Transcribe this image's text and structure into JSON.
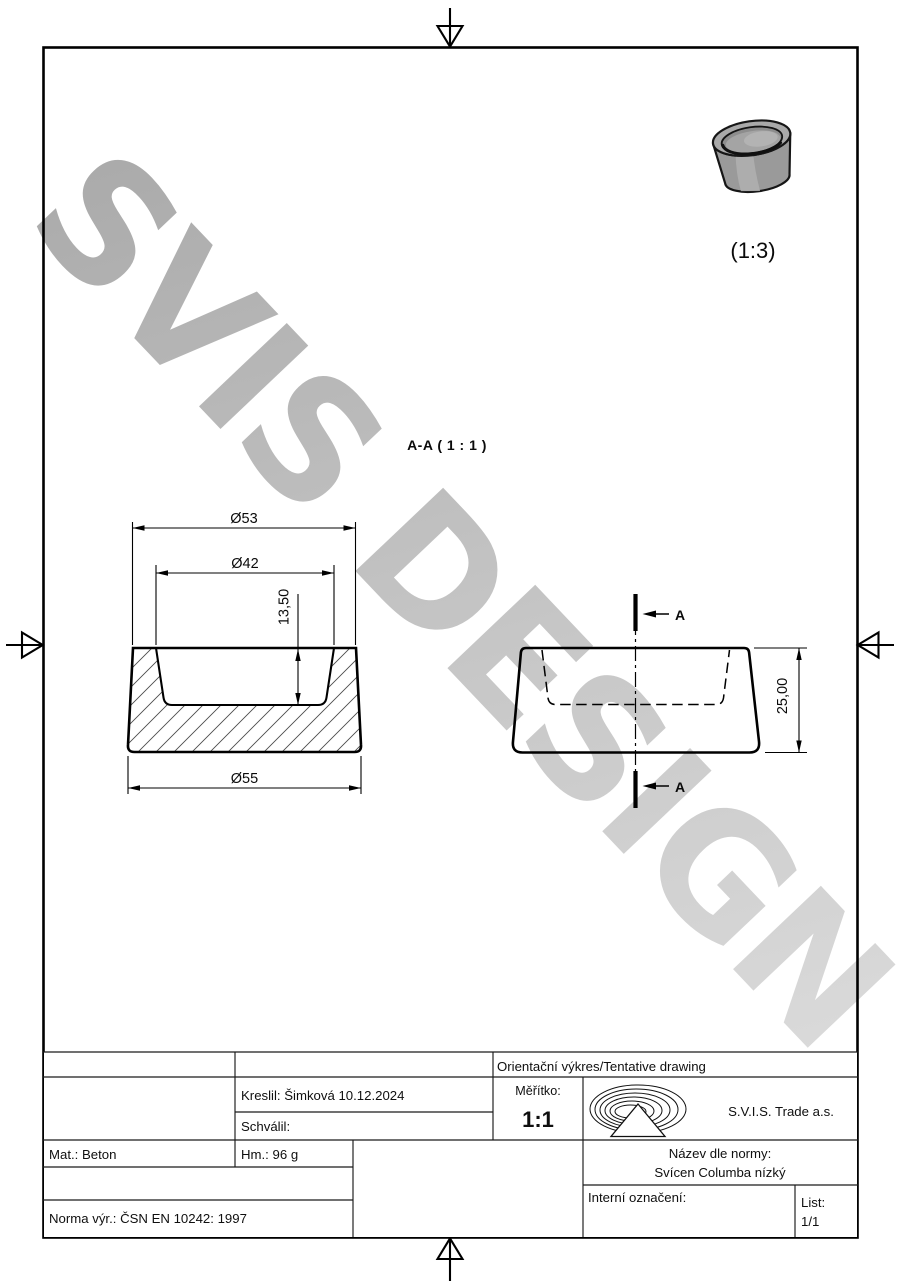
{
  "watermark": {
    "text": "SVIS DESIGN"
  },
  "views": {
    "section_label": "A-A ( 1 : 1 )",
    "perspective_scale": "(1:3)",
    "cut_letter": "A",
    "dimensions": {
      "top_outer_diameter": "Ø53",
      "inner_diameter": "Ø42",
      "cavity_depth": "13,50",
      "bottom_outer_diameter": "Ø55",
      "total_height": "25,00"
    }
  },
  "title_block": {
    "doc_type": "Orientační výkres/Tentative drawing",
    "drawn_by": "Kreslil: Šimková 10.12.2024",
    "approved_by": "Schválil:",
    "scale_label": "Měřítko:",
    "scale_value": "1:1",
    "company": "S.V.I.S. Trade a.s.",
    "material": "Mat.: Beton",
    "weight": "Hm.: 96 g",
    "name_label": "Název dle normy:",
    "name_value": "Svícen Columba nízký",
    "internal_label": "Interní označení:",
    "sheet_label": "List:",
    "sheet_value": "1/1",
    "norm": "Norma výr.: ČSN EN 10242: 1997"
  }
}
